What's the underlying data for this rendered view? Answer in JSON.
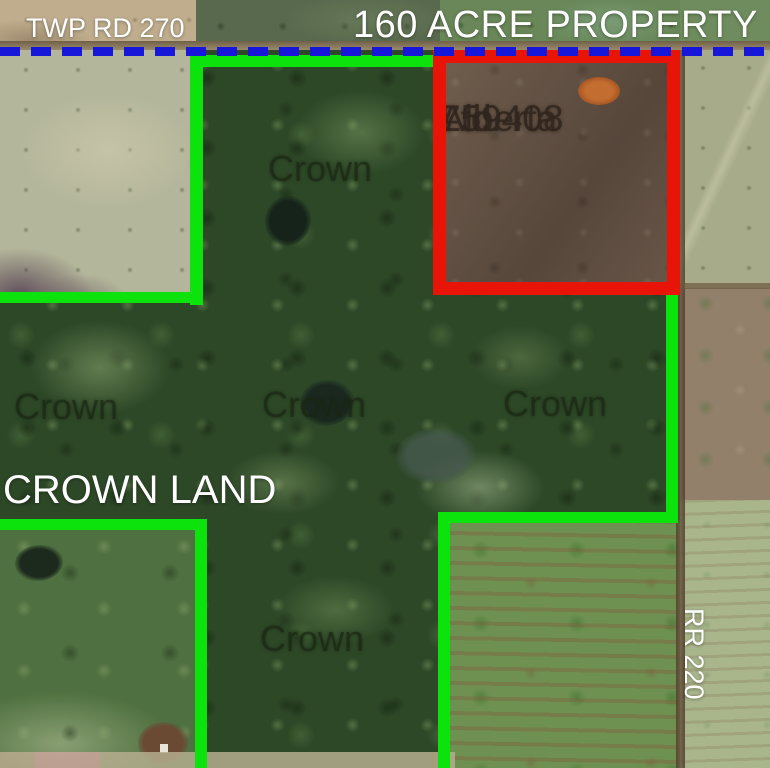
{
  "map_title": "160 ACRE PROPERTY",
  "road_labels": {
    "township_road": "TWP RD 270",
    "range_road": "RR 220"
  },
  "crown_land_label": "CROWN LAND",
  "crown_watermark_text": "Crown",
  "parcel_owner": {
    "line1": "759408",
    "line2": "Alberta",
    "line3": "Ltd."
  },
  "annotation_colors": {
    "crown_boundary_green": "#0ce30c",
    "property_outline_red": "#e81408",
    "township_road_dashed_blue": "#1617d8",
    "label_text_white": "#ffffff"
  }
}
